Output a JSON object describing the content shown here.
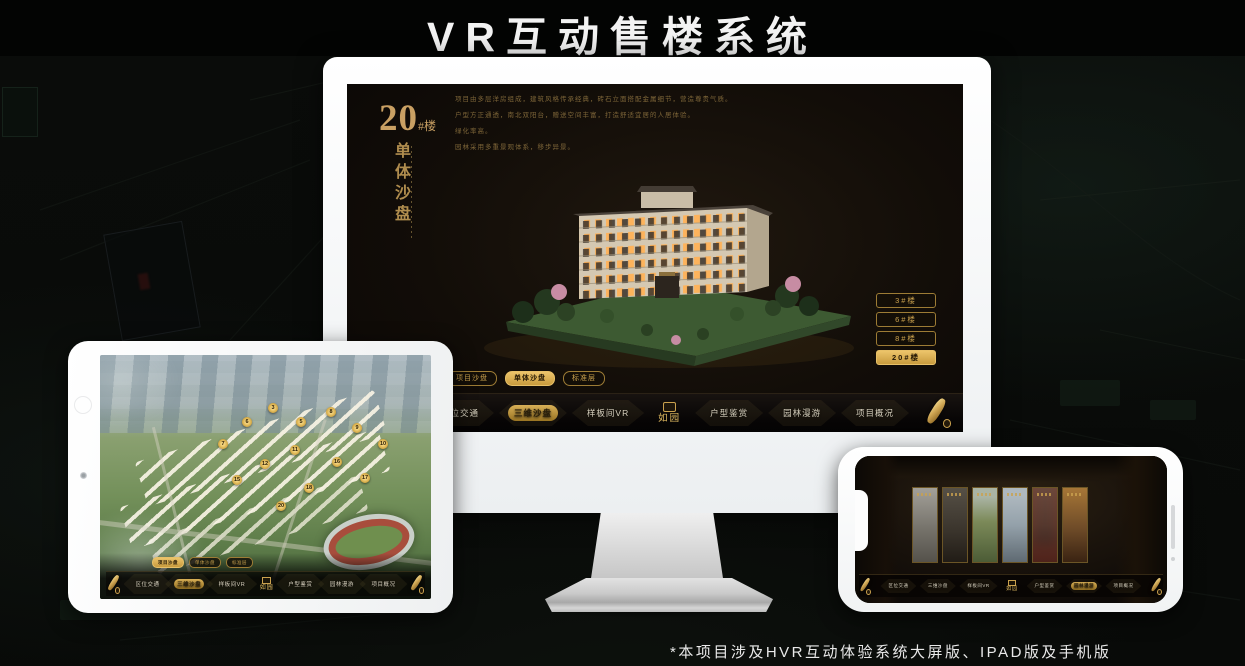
{
  "page": {
    "title": "VR互动售楼系统",
    "footnote": "*本项目涉及HVR互动体验系统大屏版、IPAD版及手机版"
  },
  "brand": {
    "logo_text": "如园",
    "accent": "#caa14e"
  },
  "nav": {
    "items": [
      {
        "label": "区位交通"
      },
      {
        "label": "三维沙盘"
      },
      {
        "label": "样板间VR"
      },
      {
        "label": "户型鉴赏"
      },
      {
        "label": "园林漫游"
      },
      {
        "label": "项目概况"
      }
    ]
  },
  "sub_tabs": {
    "items": [
      "项目沙盘",
      "单体沙盘",
      "标准层"
    ]
  },
  "monitor_ui": {
    "block_number": "20",
    "block_suffix": "#楼",
    "vertical_title": "单体沙盘",
    "desc": [
      "项目由多层洋房组成，建筑风格传承经典，砖石立面搭配金属细节，营造尊贵气质。",
      "户型方正通透，南北双阳台，赠送空间丰富，打造舒适宜居的人居体验。",
      "绿化率高。",
      "园林采用多重景观体系，移步异景。"
    ],
    "building_buttons": [
      {
        "label": "3#楼"
      },
      {
        "label": "6#楼"
      },
      {
        "label": "8#楼"
      },
      {
        "label": "20#楼"
      }
    ]
  },
  "ipad_ui": {
    "markers": [
      "3",
      "5",
      "6",
      "7",
      "8",
      "9",
      "10",
      "11",
      "12",
      "15",
      "16",
      "17",
      "18",
      "20"
    ]
  },
  "colors": {
    "gold": "#caa14e",
    "screen_bg": "#120d08",
    "phone_panels": [
      "#96938a",
      "#453f36",
      "#7c8a59",
      "#94a1aa",
      "#55392f",
      "#6e4b28"
    ]
  }
}
